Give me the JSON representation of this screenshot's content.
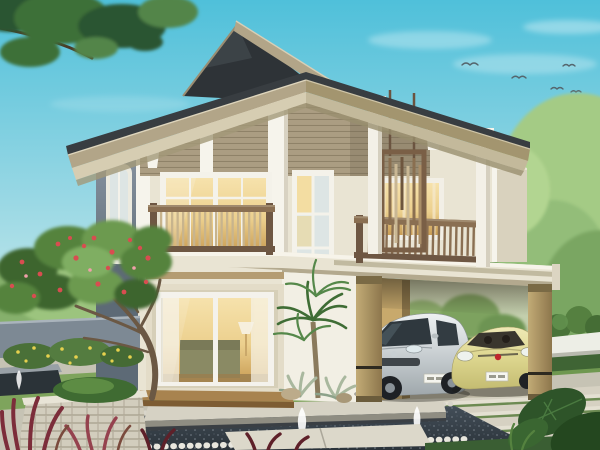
{
  "scene": {
    "type": "3d-architectural-rendering",
    "title": "Two-story house exterior rendering",
    "description": "Daytime 3D rendering of a modern tropical two-story house seen from the front-left: dark grey gable roofs with deep taupe-trimmed eaves, taupe lap siding over cream walls, a wood-railed balcony with glowing sliding doors on the left, a second balcony with a hanging wooden slat screen on the right, a double-height stair window in the middle, and an attached flat-roof carport sheltering a silver minivan and a pale yellow sedan. Landscaping includes a red-flowering frangipani tree in a stacked-stone planter, a small palm, dark reflecting pools with small fountain jets, paver paths with grass joints, burgundy foreground plants and large tropical leaves, all under a clear blue sky with a few birds and an overhanging branch in the top-left corner.",
    "time_of_day": "day",
    "view": "three-quarter front-left",
    "counts": {
      "stories": 2,
      "cars": 2,
      "birds": 5,
      "fountain_jets": 3,
      "balconies": 2
    },
    "house_features": [
      "dark charcoal gable roofs with wide overhanging eaves",
      "taupe horizontal lap siding band under the eaves",
      "white pilasters and corbel brackets",
      "left balcony with wood railing and warm-lit sliding glass doors",
      "right balcony with hanging wooden slat privacy screen and white columns",
      "double-height stair window",
      "large first-floor sliding glass door with lamp and sofa visible inside",
      "flat-roof carport on tan columns",
      "blue-grey left side wall with arched-top window"
    ],
    "vehicles": [
      {
        "kind": "minivan",
        "color_name": "silver",
        "detail": "white license plate, roof antenna"
      },
      {
        "kind": "sedan",
        "color_name": "pale yellow-green",
        "detail": "red grille badge, white license plate"
      }
    ],
    "landscape_elements": [
      "frangipani tree with red flowers",
      "stacked-stone planter",
      "yellow flowering shrubs",
      "blue-grey garden fence",
      "dark pebble reflecting pool with two fountain jets",
      "small water trough with fountain",
      "stone ledge bench",
      "paver walkway with grass joints",
      "driveway with grass strips",
      "trimmed hedge balls and white garden wall",
      "burgundy cordyline plants",
      "large tropical leaves",
      "palm with silver agaves",
      "background trees"
    ],
    "palette": {
      "sky_top": "#4fc0da",
      "sky_horizon": "#eef6f0",
      "roof_dark": "#383d41",
      "roof_darker": "#2e3337",
      "fascia_taupe": "#b2a588",
      "fascia_shade": "#a3956f",
      "soffit_cream": "#d6cdb2",
      "soffit_shade": "#c3b99b",
      "siding_taupe": "#ab9d82",
      "wall_cream": "#e9e4d3",
      "wall_white": "#f2efe4",
      "wall_shade": "#d9d2be",
      "trim_white": "#f6f4ec",
      "wall_blue_grey": "#8894a1",
      "wood_dark": "#6e5743",
      "wood_mid": "#8a6f52",
      "wood_light": "#c8b48d",
      "glass_warm": "#ecd08e",
      "glass_cool": "#dde5e4",
      "stone_light": "#d2cdbd",
      "paver_light": "#d6d1c2",
      "grass_green": "#7ea45c",
      "water_dark": "#2b333a",
      "bg_tree": "#86b06c",
      "bg_tree_light": "#a4cb85",
      "foliage_dark": "#3c652f",
      "foliage_mid": "#54833d",
      "foliage_light": "#6c9a50",
      "flower_red": "#d84d50",
      "flower_yellow": "#e6d14e",
      "plant_burgundy": "#7c2d3a",
      "car_silver": "#ccd2d5",
      "car_yellow": "#ddd68e",
      "badge_red": "#c0272d",
      "column_tan": "#b29a66"
    }
  }
}
